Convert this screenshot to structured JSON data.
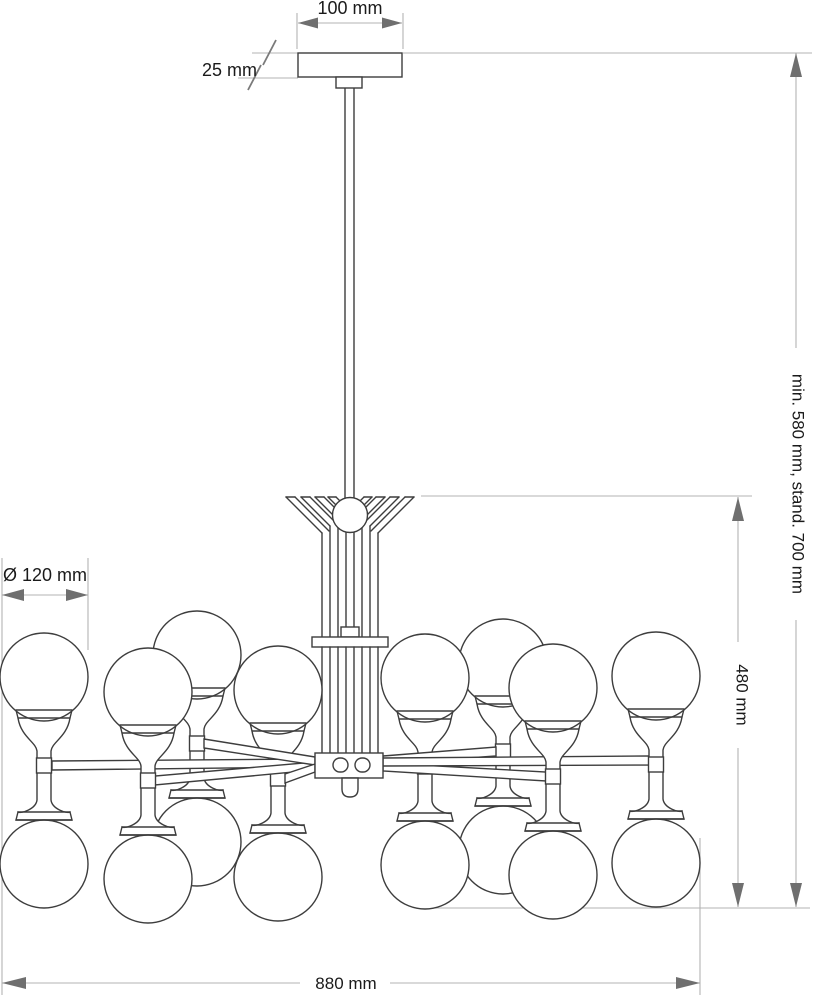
{
  "document": {
    "type": "technical dimension drawing",
    "subject": "chandelier with spherical double-globe arms"
  },
  "dimensions": {
    "canopy_width": "100 mm",
    "canopy_height": "25 mm",
    "globe_diameter": "Ø 120 mm",
    "hanging_height": "min. 580 mm, stand. 700 mm",
    "body_height": "480 mm",
    "total_width": "880 mm"
  },
  "colors": {
    "background": "#ffffff",
    "drawing_line": "#3d3d3d",
    "dimension_line": "#b3b3b3",
    "arrowhead": "#6f6f6f",
    "text": "#1a1a1a"
  }
}
